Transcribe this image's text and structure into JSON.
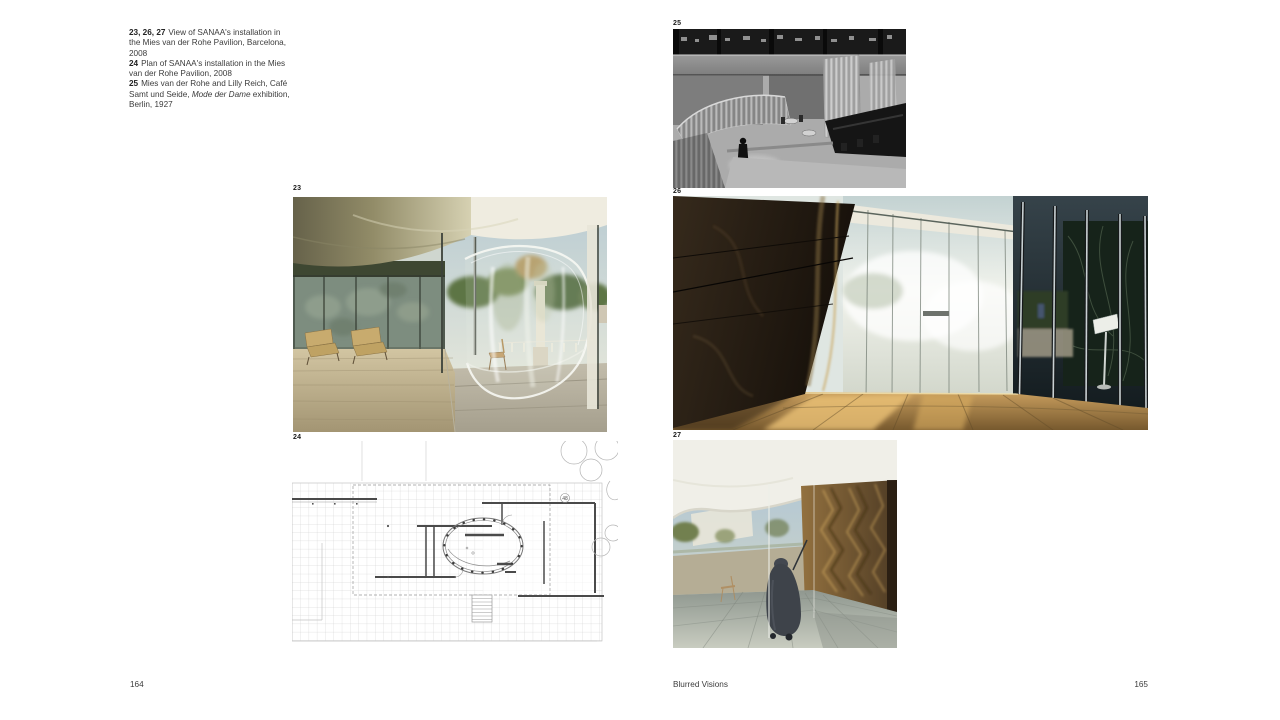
{
  "page": {
    "background": "#ffffff",
    "text_color": "#3c3c3c"
  },
  "captions": [
    {
      "num": "23, 26, 27",
      "text": "View of SANAA's installation in the Mies van der Rohe Pavilion, Barcelona, 2008",
      "italic": "",
      "after": ""
    },
    {
      "num": "24",
      "text": "Plan of SANAA's installation in the Mies van der Rohe Pavilion, 2008",
      "italic": "",
      "after": ""
    },
    {
      "num": "25",
      "text": "Mies van der Rohe and Lilly Reich, Café Samt und Seide, ",
      "italic": "Mode der Dame",
      "after": " exhibition, Berlin, 1927"
    }
  ],
  "figures": {
    "fig23": {
      "label": "23"
    },
    "fig24": {
      "label": "24",
      "annotation": "48"
    },
    "fig25": {
      "label": "25"
    },
    "fig26": {
      "label": "26"
    },
    "fig27": {
      "label": "27"
    }
  },
  "footer": {
    "left_page_number": "164",
    "title": "Blurred Visions",
    "right_page_number": "165"
  }
}
